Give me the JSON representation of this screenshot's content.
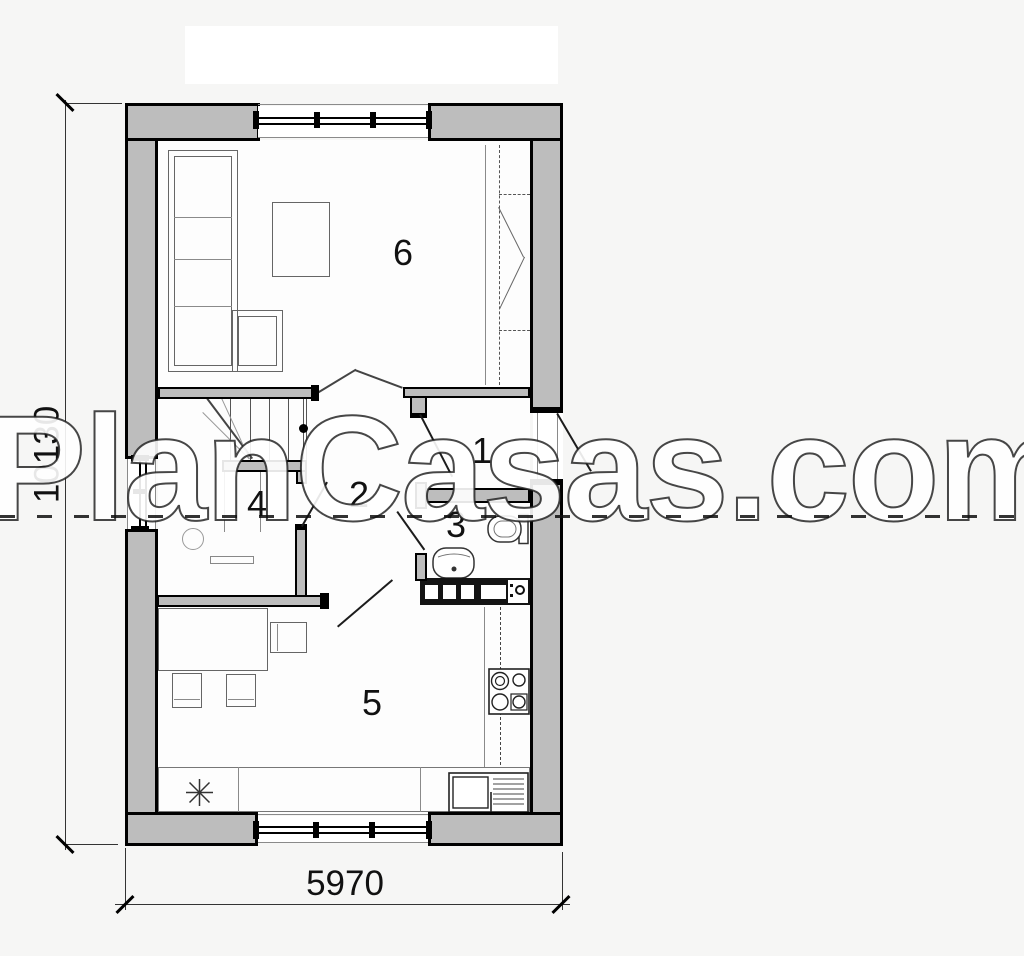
{
  "page": {
    "background": "#f6f6f5",
    "type": "architectural-floor-plan"
  },
  "watermark": {
    "text": "PlanCasas.com",
    "underline_style": "dashed"
  },
  "dimensions": {
    "vertical_total": "10130",
    "horizontal_total": "5970"
  },
  "rooms": {
    "r1": "1",
    "r2": "2",
    "r3": "3",
    "r4": "4",
    "r5": "5",
    "r6": "6"
  },
  "colors": {
    "wall_fill": "#bdbdbd",
    "wall_line": "#000000",
    "background": "#f6f6f5",
    "dim_line": "#333333"
  },
  "symbols": [
    "sofa",
    "coffee-table",
    "wardrobe-sliding-doors",
    "stairs",
    "handrail",
    "desk",
    "chair",
    "dining-table",
    "kitchen-counter",
    "stove",
    "kitchen-sink",
    "star-appliance",
    "toilet",
    "washbasin",
    "washing-machine",
    "window",
    "door-swing",
    "dimension-line"
  ]
}
